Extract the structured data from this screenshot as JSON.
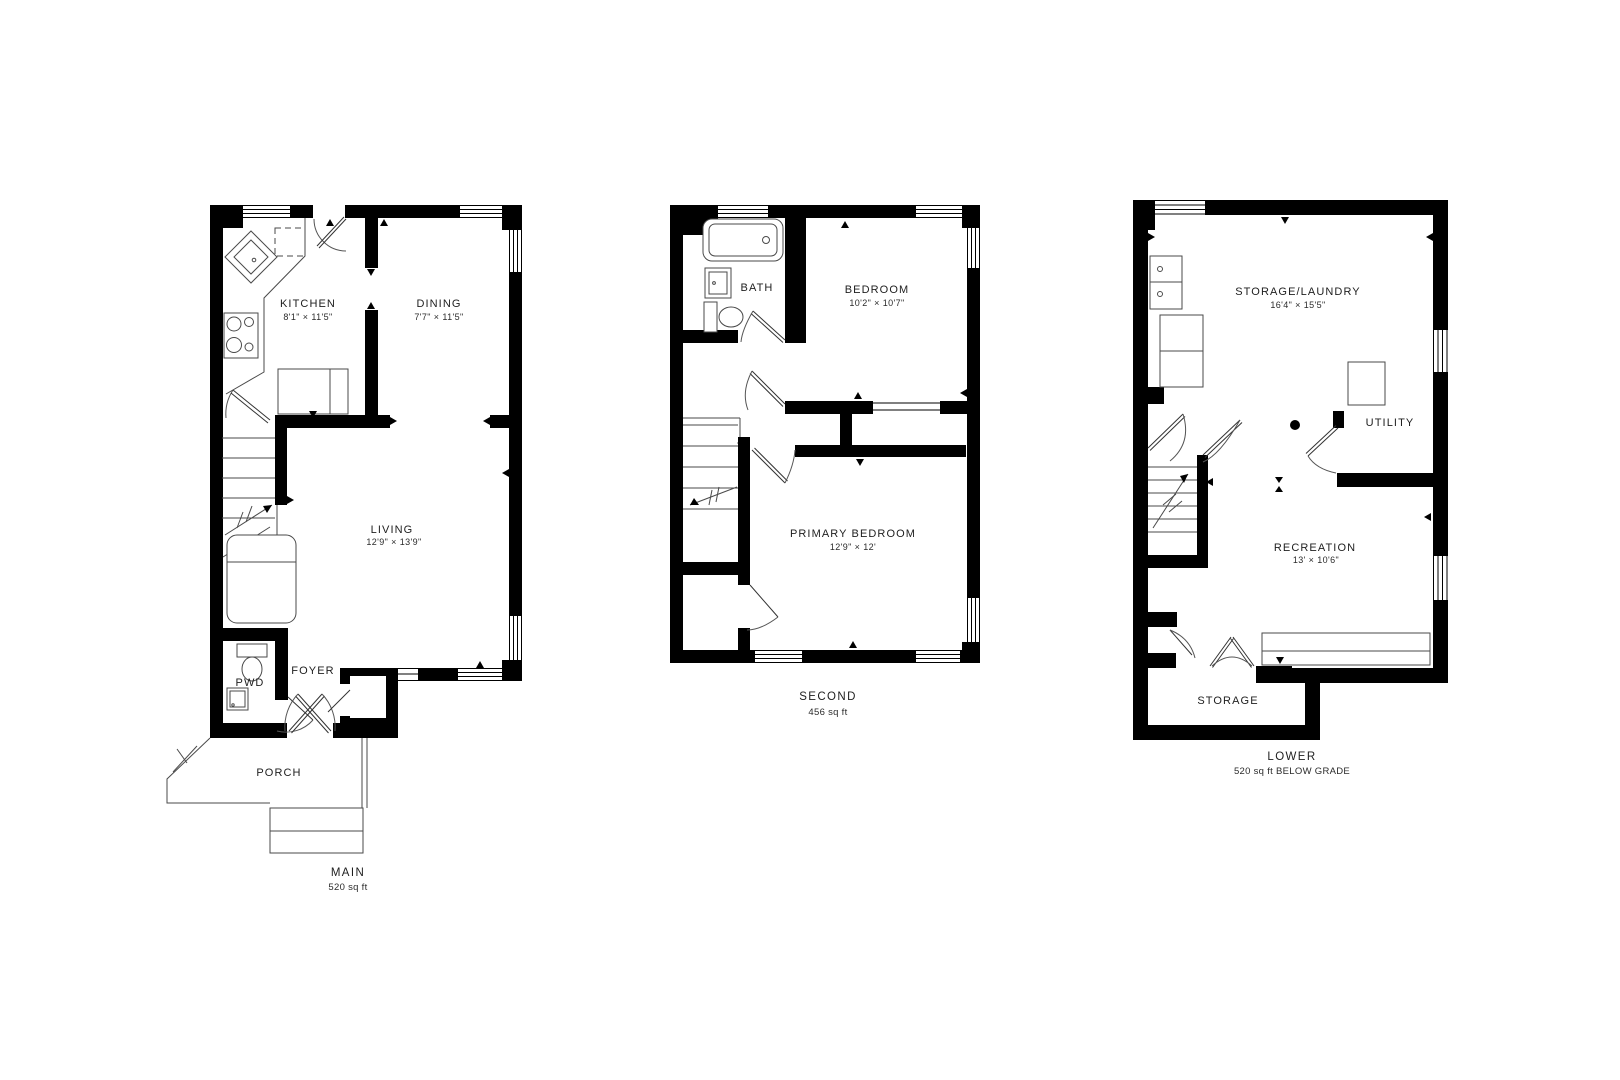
{
  "colors": {
    "wall": "#000000",
    "line": "#4a4a4a",
    "text": "#1e1e1e",
    "background": "#ffffff"
  },
  "plans": {
    "main": {
      "floor_label": "MAIN",
      "floor_area": "520 sq ft",
      "rooms": {
        "kitchen": {
          "name": "KITCHEN",
          "dims": "8'1\" × 11'5\""
        },
        "dining": {
          "name": "DINING",
          "dims": "7'7\" × 11'5\""
        },
        "living": {
          "name": "LIVING",
          "dims": "12'9\" × 13'9\""
        },
        "pwd": {
          "name": "PWD"
        },
        "foyer": {
          "name": "FOYER"
        },
        "porch": {
          "name": "PORCH"
        }
      }
    },
    "second": {
      "floor_label": "SECOND",
      "floor_area": "456 sq ft",
      "rooms": {
        "bath": {
          "name": "BATH"
        },
        "bedroom": {
          "name": "BEDROOM",
          "dims": "10'2\" × 10'7\""
        },
        "primary_bedroom": {
          "name": "PRIMARY BEDROOM",
          "dims": "12'9\" × 12'"
        }
      }
    },
    "lower": {
      "floor_label": "LOWER",
      "floor_area": "520 sq ft BELOW GRADE",
      "rooms": {
        "storage_laundry": {
          "name": "STORAGE/LAUNDRY",
          "dims": "16'4\" × 15'5\""
        },
        "utility": {
          "name": "UTILITY"
        },
        "recreation": {
          "name": "RECREATION",
          "dims": "13' × 10'6\""
        },
        "storage": {
          "name": "STORAGE"
        }
      }
    }
  }
}
